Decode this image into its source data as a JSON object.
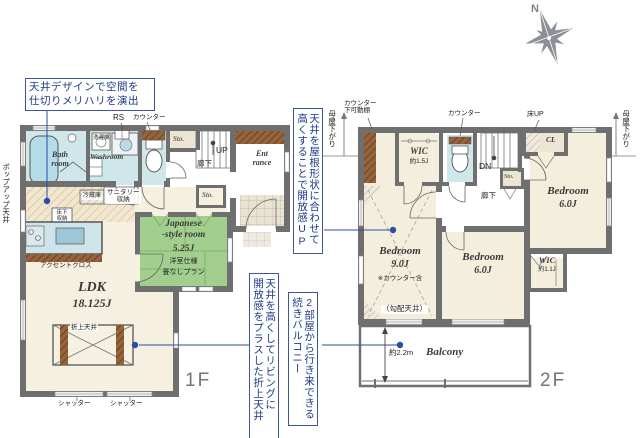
{
  "palette": {
    "wall": "#6f6f6f",
    "water_room": "#cfe7ea",
    "tatami_green": "#a3cf8e",
    "floor_cream": "#f4eedd",
    "wood_brown": "#96633a",
    "callout_navy": "#1d3a86",
    "annotation_blue": "#2b4da6",
    "compass_gray": "#8b9096"
  },
  "compass": {
    "north": "N"
  },
  "callouts": {
    "ceiling_design": {
      "line1": "天井デザインで空間を",
      "line2": "仕切りメリハリを演出"
    },
    "roof": {
      "line1": "天井を屋根形状に合わせて",
      "line2": "高くすることで開放感UP"
    },
    "coffered": {
      "line1": "天井を高くしてリビングに",
      "line2": "開放感をプラスした折上天井"
    },
    "balcony": {
      "line1": "2部屋から行き来できる",
      "line2": "続きバルコニー"
    }
  },
  "f1": {
    "floor": "1F",
    "popup": "ポップアップ天井",
    "rs": "RS",
    "counter": "カウンター",
    "sto": "Sto.",
    "up": "UP",
    "hall": "廊下",
    "entrance_l1": "Ent",
    "entrance_l2": "rance",
    "bath_l1": "Bath",
    "bath_l2": "room",
    "washroom": "Washroom",
    "washer": "洗濯機",
    "sanitary_l1": "サニタリー",
    "sanitary_l2": "収納",
    "fridge": "冷蔵庫",
    "underfloor_l1": "床下",
    "underfloor_l2": "収納",
    "accent": "アクセントクロス",
    "ldk": "LDK",
    "ldk_size": "18.125J",
    "jp_l1": "Japanese",
    "jp_l2": "-style room",
    "jp_size": "5.25J",
    "jp_note1": "洋室仕様",
    "jp_note2": "畳なしプラン",
    "coffered": "折上天井",
    "shutter": "シャッター"
  },
  "f2": {
    "floor": "2F",
    "moya": "母屋下がり",
    "counter_shelf_l1": "カウンター",
    "counter_shelf_l2": "下可動棚",
    "counter": "カウンター",
    "floor_up": "床UP",
    "cl": "CL",
    "wic": "WIC",
    "wic1_size": "約1.5J",
    "wic2_size": "約1.1J",
    "dn": "DN",
    "sto": "Sto.",
    "hall": "廊下",
    "bedroom": "Bedroom",
    "b9_size": "9.0J",
    "b9_note": "※カウンター含",
    "b9_ceiling": "（勾配天井）",
    "b6_size": "6.0J",
    "balcony": "Balcony",
    "balcony_depth": "約2.2m"
  }
}
